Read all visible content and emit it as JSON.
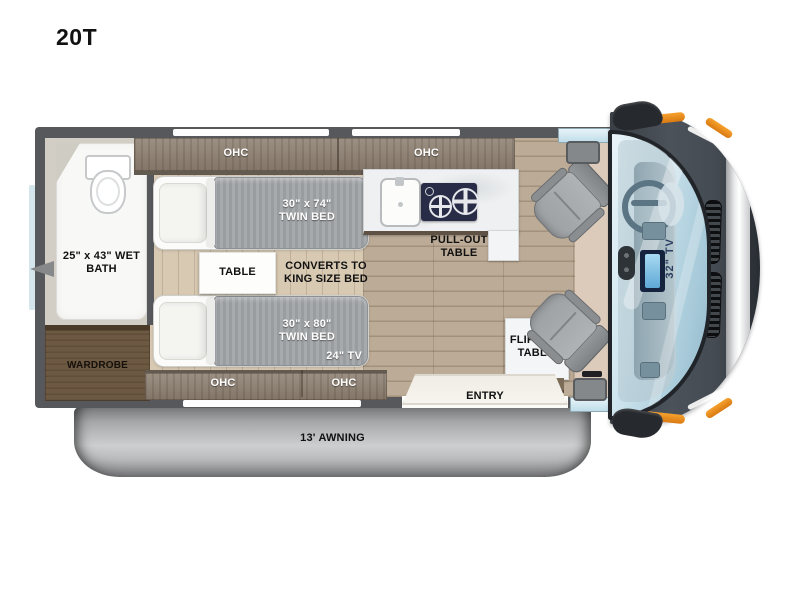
{
  "title": "20T",
  "plan": {
    "ohc": "OHC",
    "wet_bath": "25\" x 43\" WET BATH",
    "wardrobe": "WARDROBE",
    "twin_bed_top": "30\" x 74\" TWIN BED",
    "twin_bed_bottom": "30\" x 80\" TWIN BED",
    "bed_tv": "24\" TV",
    "table": "TABLE",
    "converts": "CONVERTS TO KING SIZE BED",
    "pull_out_table": "PULL-OUT TABLE",
    "flip_out_table": "FLIP-OUT TABLE",
    "entry": "ENTRY",
    "awning": "13' AWNING",
    "cab_tv": "32\" TV"
  },
  "colors": {
    "wall": "#57585c",
    "cabinet_wood": "#8e8072",
    "dark_wood": "#6d5942",
    "kitchen_floor": "#bcab96",
    "bedroom_floor": "#d8c9b3",
    "bed_blanket": "#9fa2a6",
    "counter": "#eef0f1",
    "cooktop": "#292c47",
    "chair": "#a9acaf",
    "van_body": "#41464c",
    "windshield": "#bfdbe7",
    "accent_orange": "#ef8d1f",
    "awning_gray": "#b5b6b8"
  }
}
